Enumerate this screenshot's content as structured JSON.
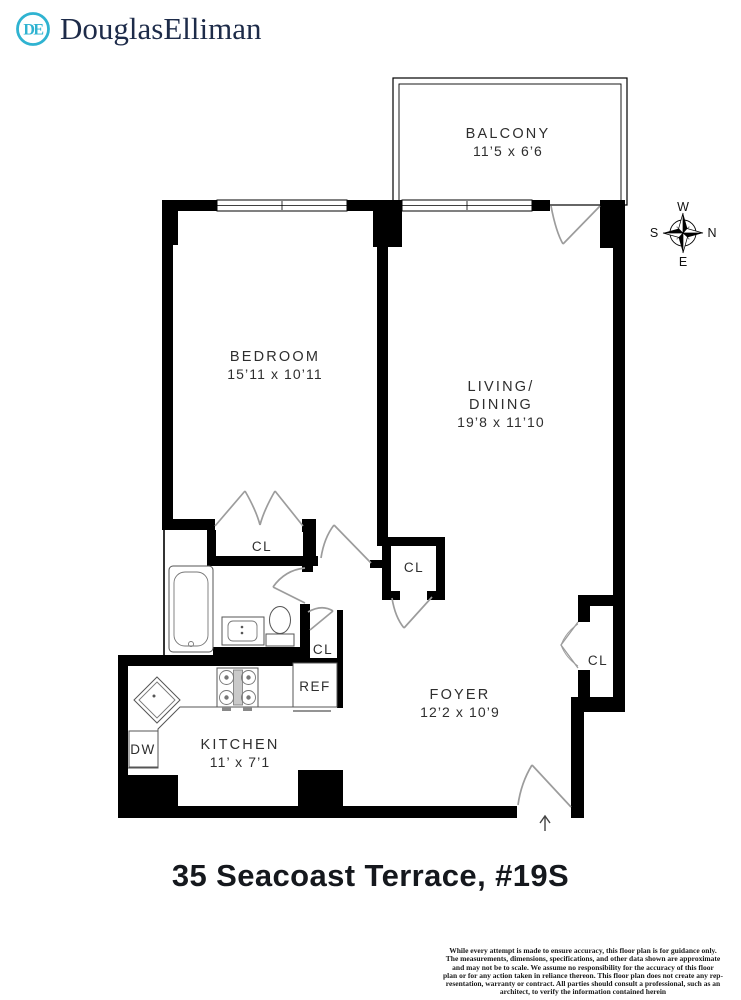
{
  "brand": {
    "name": "DouglasElliman",
    "monogram": "DE",
    "accent_color": "#2fb3d1",
    "text_color": "#1d2b49"
  },
  "plan": {
    "balcony": {
      "name": "BALCONY",
      "dims": "11’5 x 6’6"
    },
    "bedroom": {
      "name": "BEDROOM",
      "dims": "15’11 x 10’11"
    },
    "living_dining": {
      "name_line1": "LIVING/",
      "name_line2": "DINING",
      "dims": "19’8 x 11’10"
    },
    "foyer": {
      "name": "FOYER",
      "dims": "12’2 x 10’9"
    },
    "kitchen": {
      "name": "KITCHEN",
      "dims": "11’ x 7’1"
    },
    "closet_label": "CL",
    "refrigerator_label": "REF",
    "dishwasher_label": "DW",
    "compass": {
      "west": "W",
      "north": "N",
      "east": "E",
      "south": "S"
    }
  },
  "title": "35 Seacoast Terrace, #19S",
  "disclaimer": {
    "lines": [
      "While every attempt is made to ensure accuracy, this floor plan is for guidance only.",
      "The measurements, dimensions, specifications, and other data shown are approximate",
      "and may not be to scale.  We assume no responsibility for the accuracy of this floor",
      "plan or for any action taken in reliance thereon. This floor plan does not create any rep-",
      "resentation, warranty or contract. All parties should consult a professional, such as an",
      "architect, to verify the information contained herein"
    ]
  },
  "colors": {
    "wall": "#000000",
    "label_text": "#2e2e2e",
    "door_line": "#9c9c9c"
  }
}
